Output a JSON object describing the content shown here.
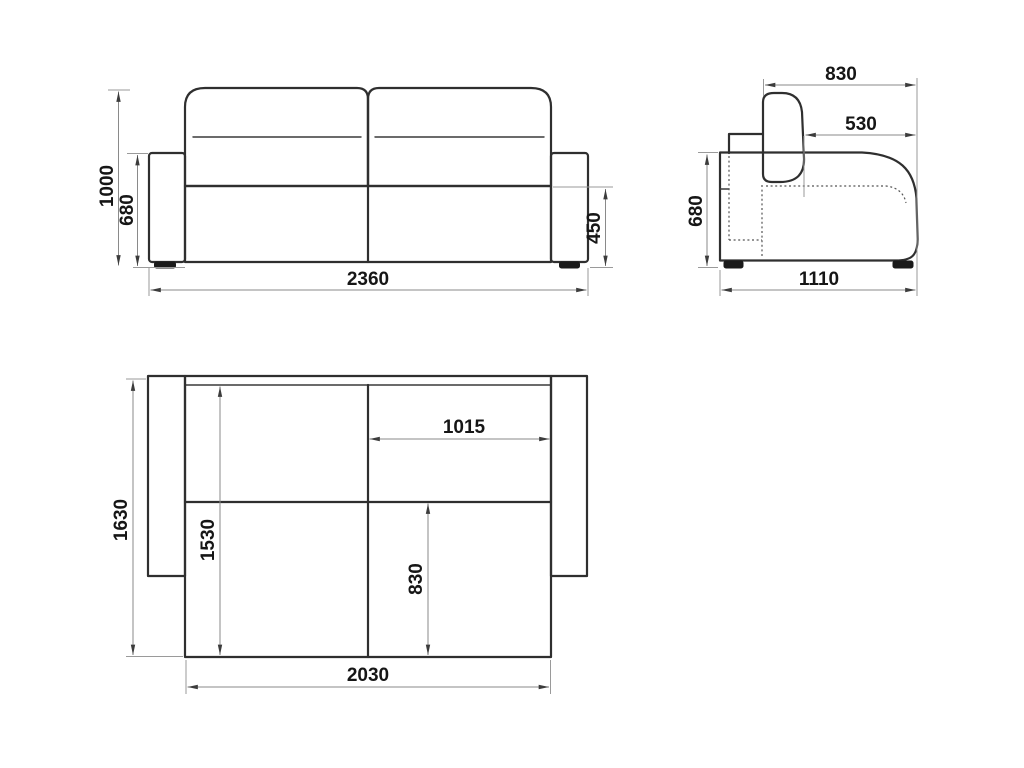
{
  "drawing": {
    "kind": "sofa-bed dimensional drawing (three orthographic views)",
    "units": "mm",
    "front_view": {
      "overall_height": "1000",
      "armrest_height": "680",
      "seat_height": "450",
      "overall_width": "2360"
    },
    "side_view": {
      "backrest_depth": "830",
      "seat_depth": "530",
      "armrest_height": "680",
      "overall_depth": "1110"
    },
    "top_view": {
      "unfolded_depth": "1630",
      "bed_length": "1530",
      "half_width": "1015",
      "bed_section_depth": "830",
      "bed_width": "2030"
    }
  },
  "colors": {
    "background": "#ffffff",
    "object_line": "#2f2f2f",
    "dimension_line": "#8a8a8a",
    "arrow": "#3c3c3c",
    "text": "#161616"
  }
}
